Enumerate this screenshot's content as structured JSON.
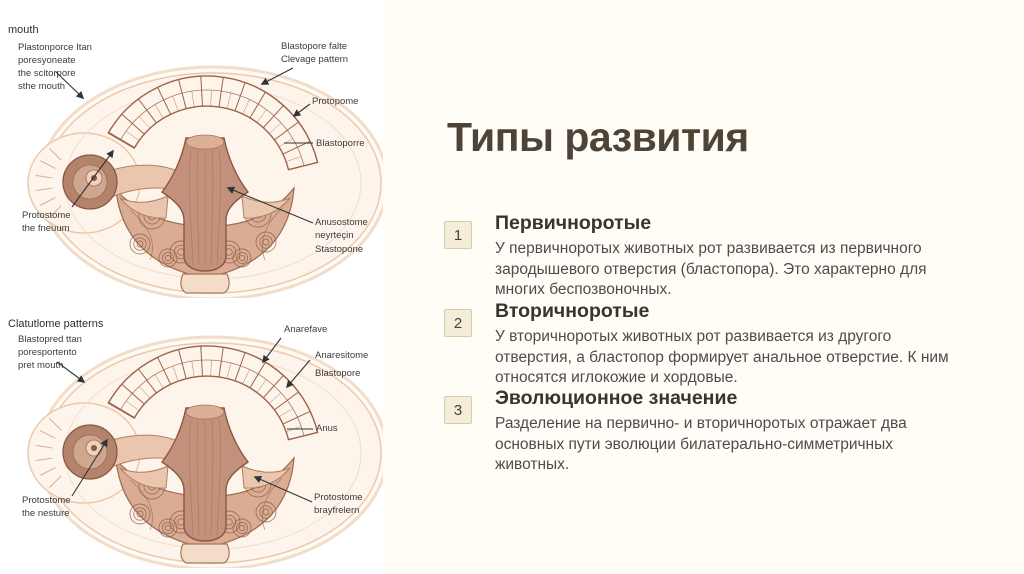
{
  "slide": {
    "title": "Типы развития",
    "sections": [
      {
        "number": "1",
        "heading": "Первичноротые",
        "body": "У первичноротых животных рот развивается из первичного\nзародышевого отверстия (бластопора). Это характерно для\nмногих беспозвоночных."
      },
      {
        "number": "2",
        "heading": "Вторичноротые",
        "body": "У вторичноротых животных рот развивается из другого\nотверстия, а бластопор формирует анальное отверстие. К ним\nотносятся иглокожие и хордовые."
      },
      {
        "number": "3",
        "heading": "Эволюционное значение",
        "body": "Разделение на первично- и вторичноротых отражает два\nосновных пути эволюции билатерально-симметричных\nживотных."
      }
    ],
    "colors": {
      "right_panel_bg": "#fffdf6",
      "left_panel_bg": "#ffffff",
      "title_color": "#4e4337",
      "heading_color": "#3a342d",
      "body_color": "#4c4c4c",
      "badge_bg": "#f4edd9",
      "badge_border": "#d8cdaa",
      "illustration_skin": "#d9ac93",
      "illustration_outline": "#8a5743"
    }
  },
  "diagrams": {
    "top": {
      "corner_label": "mouth",
      "labels": [
        {
          "text": "Plastonporce Itan\nporesyoneate\nthe scitorpore\nsthe mouth"
        },
        {
          "text": "Blastopore falte\nClevage pattern"
        },
        {
          "text": "Protopome"
        },
        {
          "text": "Blastoporre"
        },
        {
          "text": "Anusostome\nneyrteçin"
        },
        {
          "text": "Stastopone"
        },
        {
          "text": "Protostome\nthe fneuum"
        }
      ]
    },
    "bottom": {
      "corner_label": "Clatutlome patterns",
      "labels": [
        {
          "text": "Blastopred ttan\nporesportento\npret mouth"
        },
        {
          "text": "Anarefave"
        },
        {
          "text": "Anaresitome"
        },
        {
          "text": "Blastopore"
        },
        {
          "text": "Anus"
        },
        {
          "text": "Protostome\nbrayfrelern"
        },
        {
          "text": "Protostome\nthe nesture"
        }
      ]
    }
  }
}
